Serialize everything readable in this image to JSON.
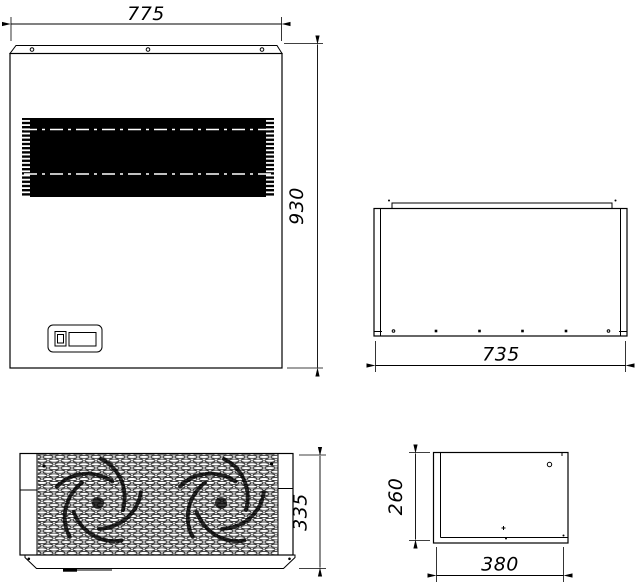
{
  "colors": {
    "background": "#ffffff",
    "ink": "#000000",
    "grille_fill": "#000000",
    "centerline": "#ffffff"
  },
  "dimensions": {
    "front_width": "775",
    "front_height": "930",
    "top_width": "735",
    "bottom_height": "335",
    "end_height": "260",
    "end_width": "380"
  }
}
